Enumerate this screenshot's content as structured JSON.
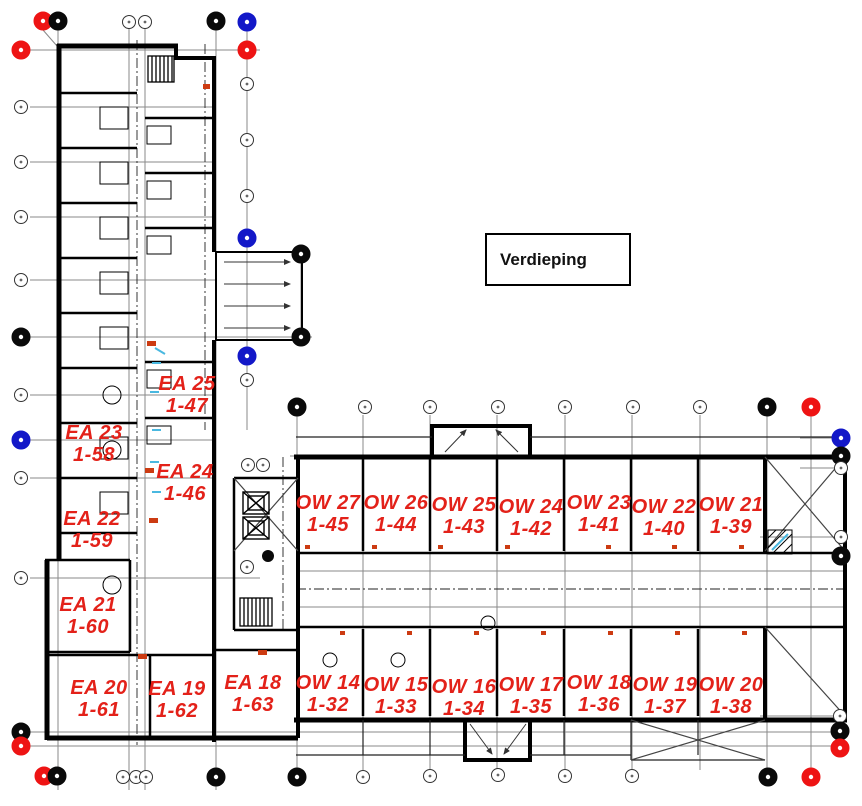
{
  "drawing": {
    "title": "Verdieping",
    "type": "architectural-floor-plan"
  },
  "colors": {
    "unit_label": "#e32119",
    "wall": "#000000",
    "grid_line": "#8a8a8a",
    "bubble_red": "#ee1414",
    "bubble_blue": "#1318c8",
    "bubble_black": "#0a0a0a",
    "accent_cyan": "#49b8e0",
    "accent_orange": "#cc3b12"
  },
  "units": [
    {
      "name": "EA 25",
      "number": "1-47",
      "x": 187,
      "y": 373
    },
    {
      "name": "EA 23",
      "number": "1-58",
      "x": 94,
      "y": 422
    },
    {
      "name": "EA 24",
      "number": "1-46",
      "x": 185,
      "y": 461
    },
    {
      "name": "EA 22",
      "number": "1-59",
      "x": 92,
      "y": 508
    },
    {
      "name": "EA 21",
      "number": "1-60",
      "x": 88,
      "y": 594
    },
    {
      "name": "EA 20",
      "number": "1-61",
      "x": 99,
      "y": 677
    },
    {
      "name": "EA 19",
      "number": "1-62",
      "x": 177,
      "y": 678
    },
    {
      "name": "EA 18",
      "number": "1-63",
      "x": 253,
      "y": 672
    },
    {
      "name": "OW 27",
      "number": "1-45",
      "x": 328,
      "y": 492
    },
    {
      "name": "OW 26",
      "number": "1-44",
      "x": 396,
      "y": 492
    },
    {
      "name": "OW 25",
      "number": "1-43",
      "x": 464,
      "y": 494
    },
    {
      "name": "OW 24",
      "number": "1-42",
      "x": 531,
      "y": 496
    },
    {
      "name": "OW 23",
      "number": "1-41",
      "x": 599,
      "y": 492
    },
    {
      "name": "OW 22",
      "number": "1-40",
      "x": 664,
      "y": 496
    },
    {
      "name": "OW 21",
      "number": "1-39",
      "x": 731,
      "y": 494
    },
    {
      "name": "OW 14",
      "number": "1-32",
      "x": 328,
      "y": 672
    },
    {
      "name": "OW 15",
      "number": "1-33",
      "x": 396,
      "y": 674
    },
    {
      "name": "OW 16",
      "number": "1-34",
      "x": 464,
      "y": 676
    },
    {
      "name": "OW 17",
      "number": "1-35",
      "x": 531,
      "y": 674
    },
    {
      "name": "OW 18",
      "number": "1-36",
      "x": 599,
      "y": 672
    },
    {
      "name": "OW 19",
      "number": "1-37",
      "x": 665,
      "y": 674
    },
    {
      "name": "OW 20",
      "number": "1-38",
      "x": 731,
      "y": 674
    }
  ],
  "grid_bubbles": [
    {
      "x": 43,
      "y": 21,
      "c": "R"
    },
    {
      "x": 58,
      "y": 21,
      "c": "K"
    },
    {
      "x": 129,
      "y": 22,
      "c": "W"
    },
    {
      "x": 145,
      "y": 22,
      "c": "W"
    },
    {
      "x": 216,
      "y": 21,
      "c": "K"
    },
    {
      "x": 247,
      "y": 22,
      "c": "B"
    },
    {
      "x": 21,
      "y": 50,
      "c": "R"
    },
    {
      "x": 247,
      "y": 50,
      "c": "R"
    },
    {
      "x": 21,
      "y": 107,
      "c": "W"
    },
    {
      "x": 247,
      "y": 84,
      "c": "W"
    },
    {
      "x": 21,
      "y": 162,
      "c": "W"
    },
    {
      "x": 247,
      "y": 140,
      "c": "W"
    },
    {
      "x": 21,
      "y": 217,
      "c": "W"
    },
    {
      "x": 247,
      "y": 196,
      "c": "W"
    },
    {
      "x": 21,
      "y": 280,
      "c": "W"
    },
    {
      "x": 247,
      "y": 238,
      "c": "B"
    },
    {
      "x": 301,
      "y": 254,
      "c": "K"
    },
    {
      "x": 21,
      "y": 337,
      "c": "K"
    },
    {
      "x": 301,
      "y": 337,
      "c": "K"
    },
    {
      "x": 247,
      "y": 356,
      "c": "B"
    },
    {
      "x": 247,
      "y": 380,
      "c": "W"
    },
    {
      "x": 21,
      "y": 395,
      "c": "W"
    },
    {
      "x": 21,
      "y": 440,
      "c": "B"
    },
    {
      "x": 21,
      "y": 478,
      "c": "W"
    },
    {
      "x": 248,
      "y": 465,
      "c": "W"
    },
    {
      "x": 263,
      "y": 465,
      "c": "W"
    },
    {
      "x": 21,
      "y": 578,
      "c": "W"
    },
    {
      "x": 247,
      "y": 567,
      "c": "W"
    },
    {
      "x": 297,
      "y": 407,
      "c": "K"
    },
    {
      "x": 365,
      "y": 407,
      "c": "W"
    },
    {
      "x": 430,
      "y": 407,
      "c": "W"
    },
    {
      "x": 498,
      "y": 407,
      "c": "W"
    },
    {
      "x": 565,
      "y": 407,
      "c": "W"
    },
    {
      "x": 633,
      "y": 407,
      "c": "W"
    },
    {
      "x": 700,
      "y": 407,
      "c": "W"
    },
    {
      "x": 767,
      "y": 407,
      "c": "K"
    },
    {
      "x": 811,
      "y": 407,
      "c": "R"
    },
    {
      "x": 841,
      "y": 438,
      "c": "B"
    },
    {
      "x": 841,
      "y": 456,
      "c": "K"
    },
    {
      "x": 841,
      "y": 468,
      "c": "W"
    },
    {
      "x": 841,
      "y": 537,
      "c": "W"
    },
    {
      "x": 841,
      "y": 556,
      "c": "K"
    },
    {
      "x": 840,
      "y": 716,
      "c": "W"
    },
    {
      "x": 840,
      "y": 731,
      "c": "K"
    },
    {
      "x": 840,
      "y": 748,
      "c": "R"
    },
    {
      "x": 21,
      "y": 732,
      "c": "K"
    },
    {
      "x": 21,
      "y": 746,
      "c": "R"
    },
    {
      "x": 44,
      "y": 776,
      "c": "R"
    },
    {
      "x": 57,
      "y": 776,
      "c": "K"
    },
    {
      "x": 123,
      "y": 777,
      "c": "W"
    },
    {
      "x": 136,
      "y": 777,
      "c": "W"
    },
    {
      "x": 146,
      "y": 777,
      "c": "W"
    },
    {
      "x": 216,
      "y": 777,
      "c": "K"
    },
    {
      "x": 297,
      "y": 777,
      "c": "K"
    },
    {
      "x": 363,
      "y": 777,
      "c": "W"
    },
    {
      "x": 430,
      "y": 776,
      "c": "W"
    },
    {
      "x": 498,
      "y": 775,
      "c": "W"
    },
    {
      "x": 565,
      "y": 776,
      "c": "W"
    },
    {
      "x": 632,
      "y": 776,
      "c": "W"
    },
    {
      "x": 768,
      "y": 777,
      "c": "K"
    },
    {
      "x": 811,
      "y": 777,
      "c": "R"
    }
  ]
}
